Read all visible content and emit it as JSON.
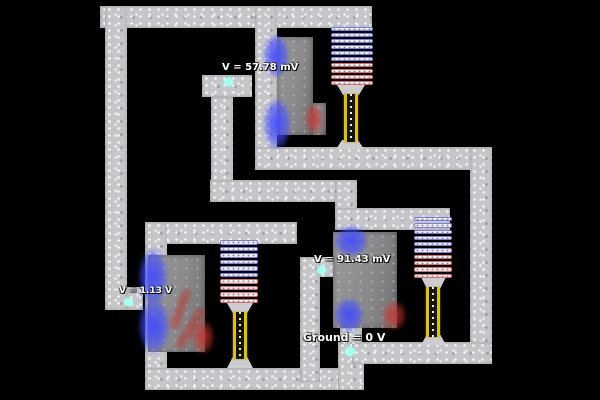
{
  "labels": {
    "probe_top": "V = 57.78 mV",
    "probe_left": "V = 1.13 V",
    "probe_mid": "V = 91.43 mV",
    "ground": "Ground = 0 V"
  },
  "colors": {
    "background": "#000000",
    "wire": "#c6c6ca",
    "plate": "#8e8e90",
    "negative_charge": "#404aff",
    "positive_charge": "#ca3630",
    "ladder_blue": "#7b7bd8",
    "ladder_red": "#d86b6b",
    "filament_yellow": "#d8c020",
    "probe_dot": "#aaffee",
    "label_text": "#ffffff"
  },
  "components": {
    "resistor_ladders": 3,
    "filament_resistors": 3,
    "conductor_plates": 3,
    "voltage_probes": 4
  }
}
